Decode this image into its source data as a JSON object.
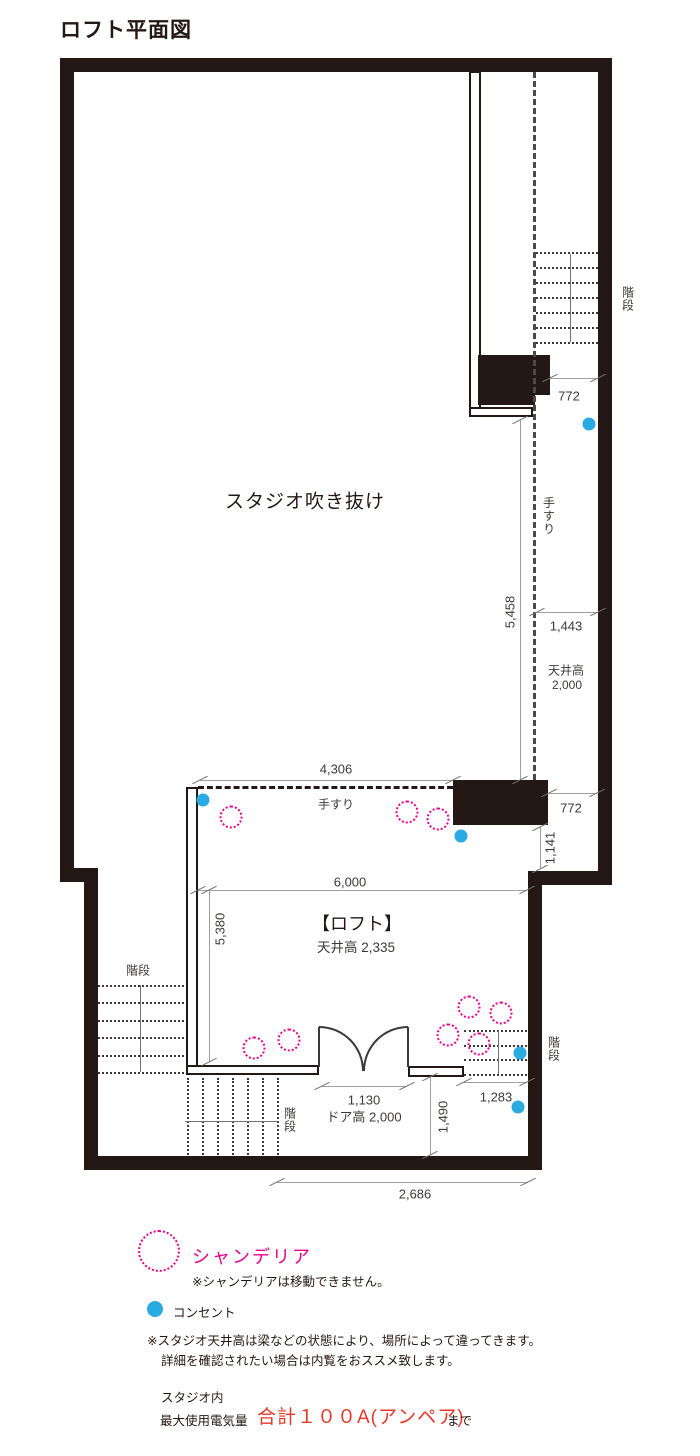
{
  "title": "ロフト平面図",
  "plan": {
    "studio_void_label": "スタジオ吹き抜け",
    "loft_name": "【ロフト】",
    "loft_ceiling": "天井高 2,335",
    "handrail_loft": "手すり",
    "handrail_side": "手すり",
    "stairs_top_right": "階段",
    "stairs_bottom_left": "階段",
    "stairs_bottom_center": "階段",
    "stairs_bottom_right": "階段",
    "ceiling_side_line1": "天井高",
    "ceiling_side_line2": "2,000",
    "dims": {
      "top_772": "772",
      "v_5458": "5,458",
      "w_1443": "1,443",
      "w_4306": "4,306",
      "loft_772": "772",
      "v_1141": "1,141",
      "w_6000": "6,000",
      "v_5380": "5,380",
      "door_1130": "1,130",
      "door_height": "ドア高 2,000",
      "v_1490": "1,490",
      "w_1283": "1,283",
      "w_2686": "2,686"
    },
    "markers": {
      "chandeliers": [
        [
          231,
          817
        ],
        [
          407,
          812
        ],
        [
          438,
          819
        ],
        [
          254,
          1048
        ],
        [
          289,
          1040
        ],
        [
          469,
          1007
        ],
        [
          501,
          1013
        ],
        [
          448,
          1035
        ],
        [
          479,
          1044
        ]
      ],
      "outlets": [
        [
          589,
          424
        ],
        [
          203,
          800
        ],
        [
          461,
          836
        ],
        [
          520,
          1053
        ],
        [
          518,
          1107
        ]
      ]
    }
  },
  "legend": {
    "chandelier_label": "シャンデリア",
    "chandelier_note": "※シャンデリアは移動できません。",
    "outlet_label": "コンセント"
  },
  "notes": {
    "ceiling_note_line1": "※スタジオ天井高は梁などの状態により、場所によって違ってきます。",
    "ceiling_note_line2": "詳細を確認されたい場合は内覧をおススメ致します。",
    "power_line1": "スタジオ内",
    "power_line2": "最大使用電気量",
    "power_value": "合計１００A(アンペア)",
    "power_suffix": "まで"
  },
  "colors": {
    "wall": "#231815",
    "chandelier_pink": "#ec008c",
    "outlet_blue": "#29abe2",
    "power_red": "#e83828"
  }
}
